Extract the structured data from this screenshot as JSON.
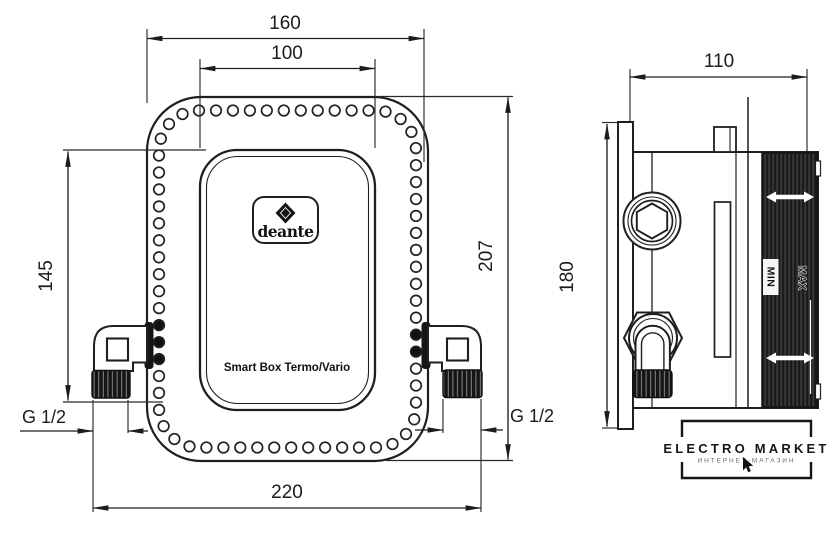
{
  "drawing": {
    "front": {
      "brand_logo": "deante",
      "product_label": "Smart Box Termo/Vario",
      "dim_flange_width": "160",
      "dim_inner_width": "100",
      "dim_height_partial": "145",
      "dim_height_total": "207",
      "dim_total_width": "220",
      "thread_left": "G 1/2",
      "thread_right": "G 1/2"
    },
    "side": {
      "dim_depth": "110",
      "dim_plate_height": "180",
      "label_min": "MIN",
      "label_max": "MAX"
    },
    "watermark": {
      "title": "ELECTRO MARKET",
      "subtitle": "ИНТЕРНЕТ-МАГАЗИН"
    },
    "colors": {
      "line": "#1f1f1f",
      "dark_fill": "#161616",
      "background": "#ffffff"
    }
  }
}
